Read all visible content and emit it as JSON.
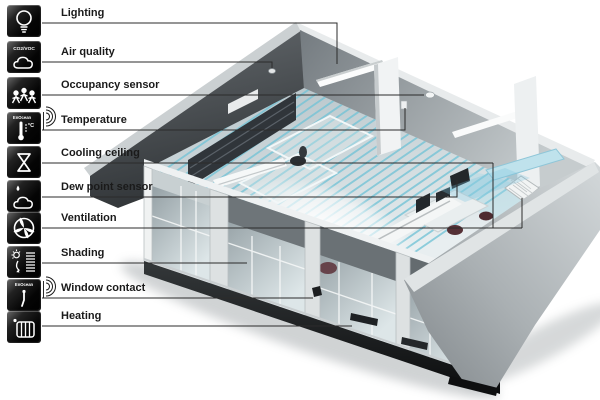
{
  "diagram_title": "Room automation functions diagram",
  "legend": {
    "items": [
      {
        "label": "Lighting",
        "icon": "lightbulb-icon"
      },
      {
        "label": "Air quality",
        "icon": "air-quality-cloud-icon",
        "icon_text": "CO2/VOC"
      },
      {
        "label": "Occupancy sensor",
        "icon": "occupancy-people-icon"
      },
      {
        "label": "Temperature",
        "icon": "thermometer-icon",
        "icon_text": "EnOcean",
        "icon_text2": "°C",
        "wireless": true
      },
      {
        "label": "Cooling ceiling",
        "icon": "cooling-ceiling-icon"
      },
      {
        "label": "Dew point sensor",
        "icon": "dew-point-icon"
      },
      {
        "label": "Ventilation",
        "icon": "ventilation-fan-icon"
      },
      {
        "label": "Shading",
        "icon": "shading-blinds-icon"
      },
      {
        "label": "Window contact",
        "icon": "window-contact-icon",
        "icon_text": "EnOcean",
        "wireless": true
      },
      {
        "label": "Heating",
        "icon": "radiator-icon"
      }
    ]
  },
  "colors": {
    "coil_blue": "#74c3d6",
    "duct_blue": "#bfe2ec",
    "wall_dark": "#4c5154",
    "wall_light": "#b9c0c3",
    "line_color": "#2b2b2b",
    "background": "#ffffff"
  }
}
